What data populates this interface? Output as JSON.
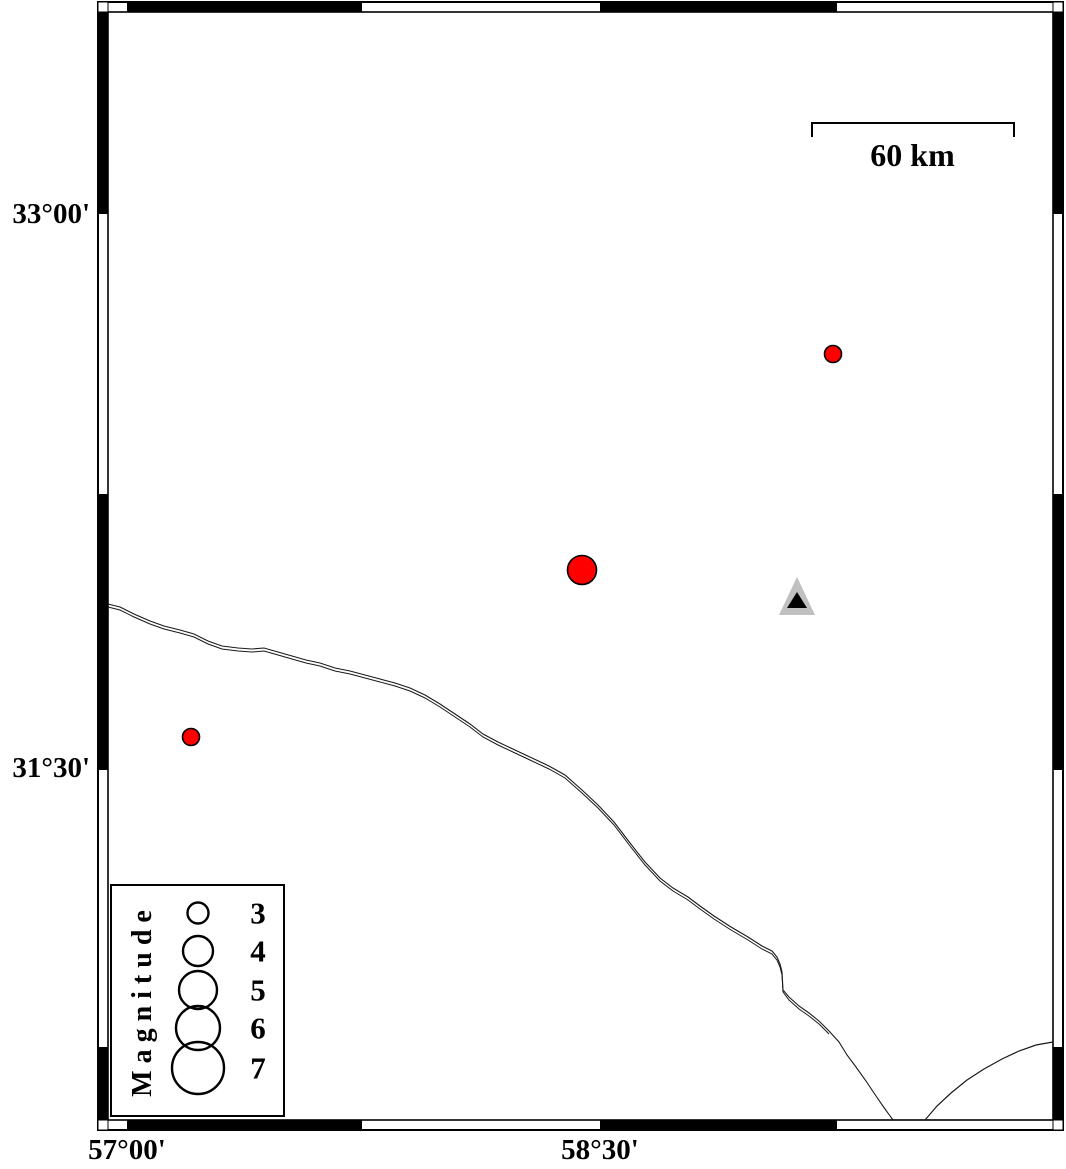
{
  "map_frame": {
    "y_axis": [
      {
        "label": "33°00'"
      },
      {
        "label": "31°30'"
      }
    ],
    "x_axis": [
      {
        "label": "57°00'"
      },
      {
        "label": "58°30'"
      }
    ]
  },
  "scale_bar": {
    "label": "60 km"
  },
  "legend": {
    "title": "Magnitude",
    "entries": [
      {
        "label": "3",
        "radius": 10.5,
        "cy": 913
      },
      {
        "label": "4",
        "radius": 15,
        "cy": 951
      },
      {
        "label": "5",
        "radius": 19,
        "cy": 990
      },
      {
        "label": "6",
        "radius": 22,
        "cy": 1028
      },
      {
        "label": "7",
        "radius": 26,
        "cy": 1068
      }
    ]
  },
  "markers": {
    "earthquakes": [
      {
        "x": 582,
        "y": 570,
        "radius": 14.5
      },
      {
        "x": 833,
        "y": 354,
        "radius": 8.5
      },
      {
        "x": 191,
        "y": 737,
        "radius": 8.5
      }
    ],
    "station": {
      "x": 797,
      "y": 600
    }
  },
  "colors": {
    "earthquake_fill": "#ff0000",
    "earthquake_stroke": "#000000",
    "station_outer": "#c0c0c0",
    "station_inner": "#000000",
    "frame": "#000000",
    "boundary_line": "#1a1a1a"
  }
}
